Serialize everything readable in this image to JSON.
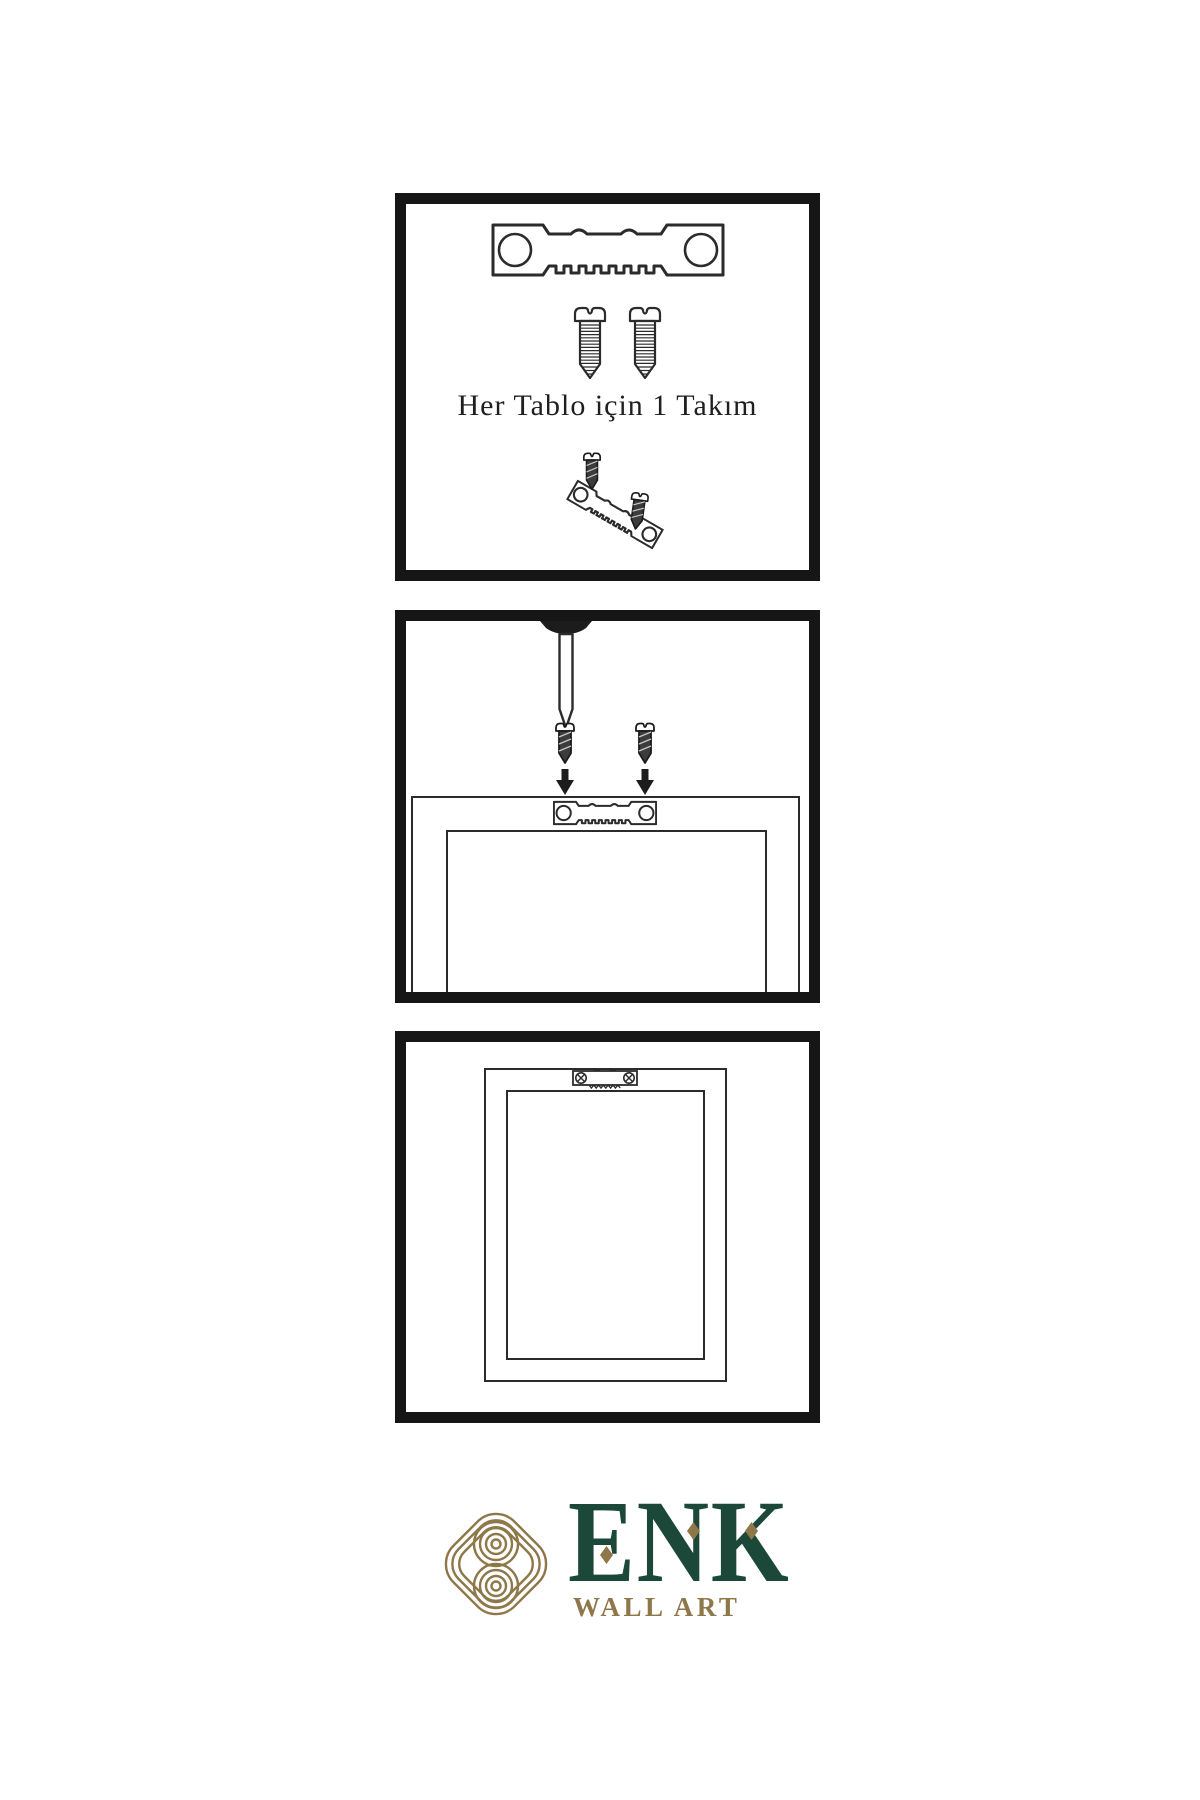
{
  "meta": {
    "type": "wall-art-hanging-instructions",
    "language": "tr"
  },
  "colors": {
    "background": "#ffffff",
    "panel_border": "#161616",
    "line_art": "#2b2b2b",
    "screw_dark_fill": "#3c3c3c",
    "brand_green": "#1b4838",
    "brand_gold": "#8e7748"
  },
  "panels": [
    {
      "name": "hanging-kit-contents",
      "caption": "Her Tablo için 1 Takım",
      "items": [
        "sawtooth-hanger",
        "screw",
        "screw",
        "screw-into-tilted-hanger-assembly"
      ]
    },
    {
      "name": "wall-nail-and-frame-mounting",
      "items": [
        "wall-nail",
        "dark-screw-with-down-arrow",
        "dark-screw-with-down-arrow",
        "frame-back-with-sawtooth-hanger"
      ]
    },
    {
      "name": "hanger-mounted-on-frame-back",
      "items": [
        "frame-back",
        "mounted-sawtooth-hanger-with-phillips-screws"
      ]
    }
  ],
  "logo": {
    "brand": "ENK",
    "subtitle": "WALL ART"
  }
}
